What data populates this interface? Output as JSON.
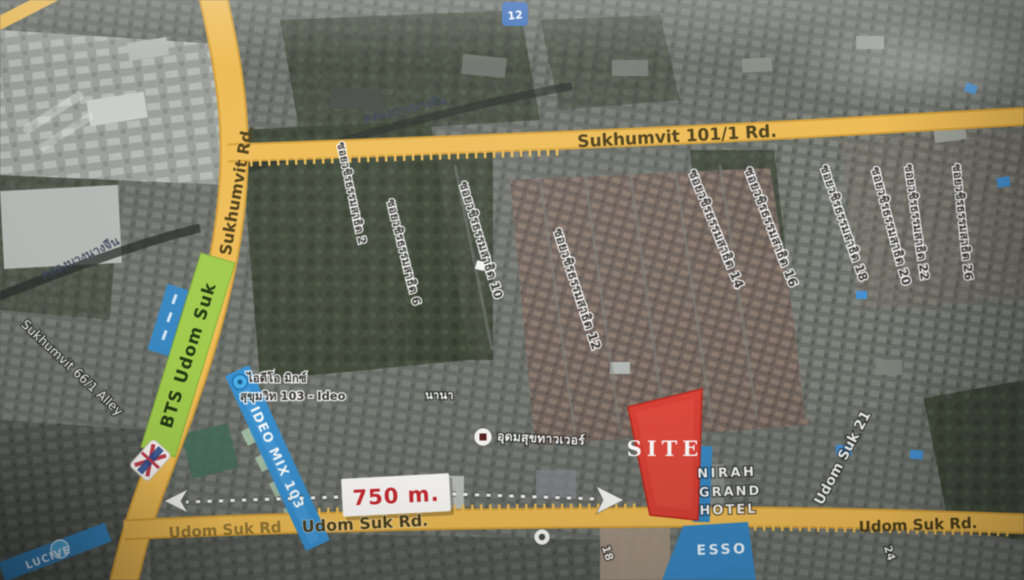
{
  "colors": {
    "road_yellow": "#f2ba46",
    "site_red": "#e63a2e",
    "bts_green": "#9ccb3b",
    "ribbon_blue": "#2e8fd6",
    "distance_red": "#d2252b"
  },
  "roads": {
    "sukhumvit": "Sukhumvit Rd.",
    "sukhumvit_101_1": "Sukhumvit 101/1 Rd.",
    "udom_suk": "Udom Suk Rd.",
    "udom_suk_faded": "Udom Suk Rd",
    "udom_suk_right": "Udom Suk Rd.",
    "alley_66_1": "Sukhumvit 66/1 Alley",
    "udom_suk_21": "Udom Suk 21",
    "canal": "คลองบางนางจีน",
    "soi_18": "18",
    "soi_24": "24"
  },
  "sois": {
    "labels": [
      "ซอยวชิรธรรมสาธิต 2",
      "ซอยวชิรธรรมสาธิต 6",
      "ซอยวชิรธรรมสาธิต 10",
      "ซอยวชิรธรรมสาธิต 12",
      "ซอยวชิรธรรมสาธิต 14",
      "ซอยวชิรธรรมสาธิต 16",
      "ซอยวชิรธรรมสาธิต 18",
      "ซอยวชิรธรรมสาธิต 20",
      "ซอยวชิรธรรมสาธิต 22",
      "ซอยวชิรธรรมสาธิต 26"
    ]
  },
  "site": {
    "label": "SITE"
  },
  "distance": {
    "label": "750 m."
  },
  "bts": {
    "label": "BTS  Udom Suk"
  },
  "hotel": {
    "line1": "NIRAH",
    "line2": "GRAND",
    "line3": "HOTEL"
  },
  "ideo": {
    "ribbon": "IDEO MIX 103",
    "thai_line1": "ไอดีโอ มิกซ์",
    "thai_line2": "สุขุมวิท 103 - Ideo",
    "side_note": "นานา"
  },
  "pois": {
    "udomsuk_tower": "อุดมสุขทาวเวอร์",
    "esso": "ESSO",
    "condo_ribbon": "LUCIVE",
    "chip_12": "12"
  }
}
